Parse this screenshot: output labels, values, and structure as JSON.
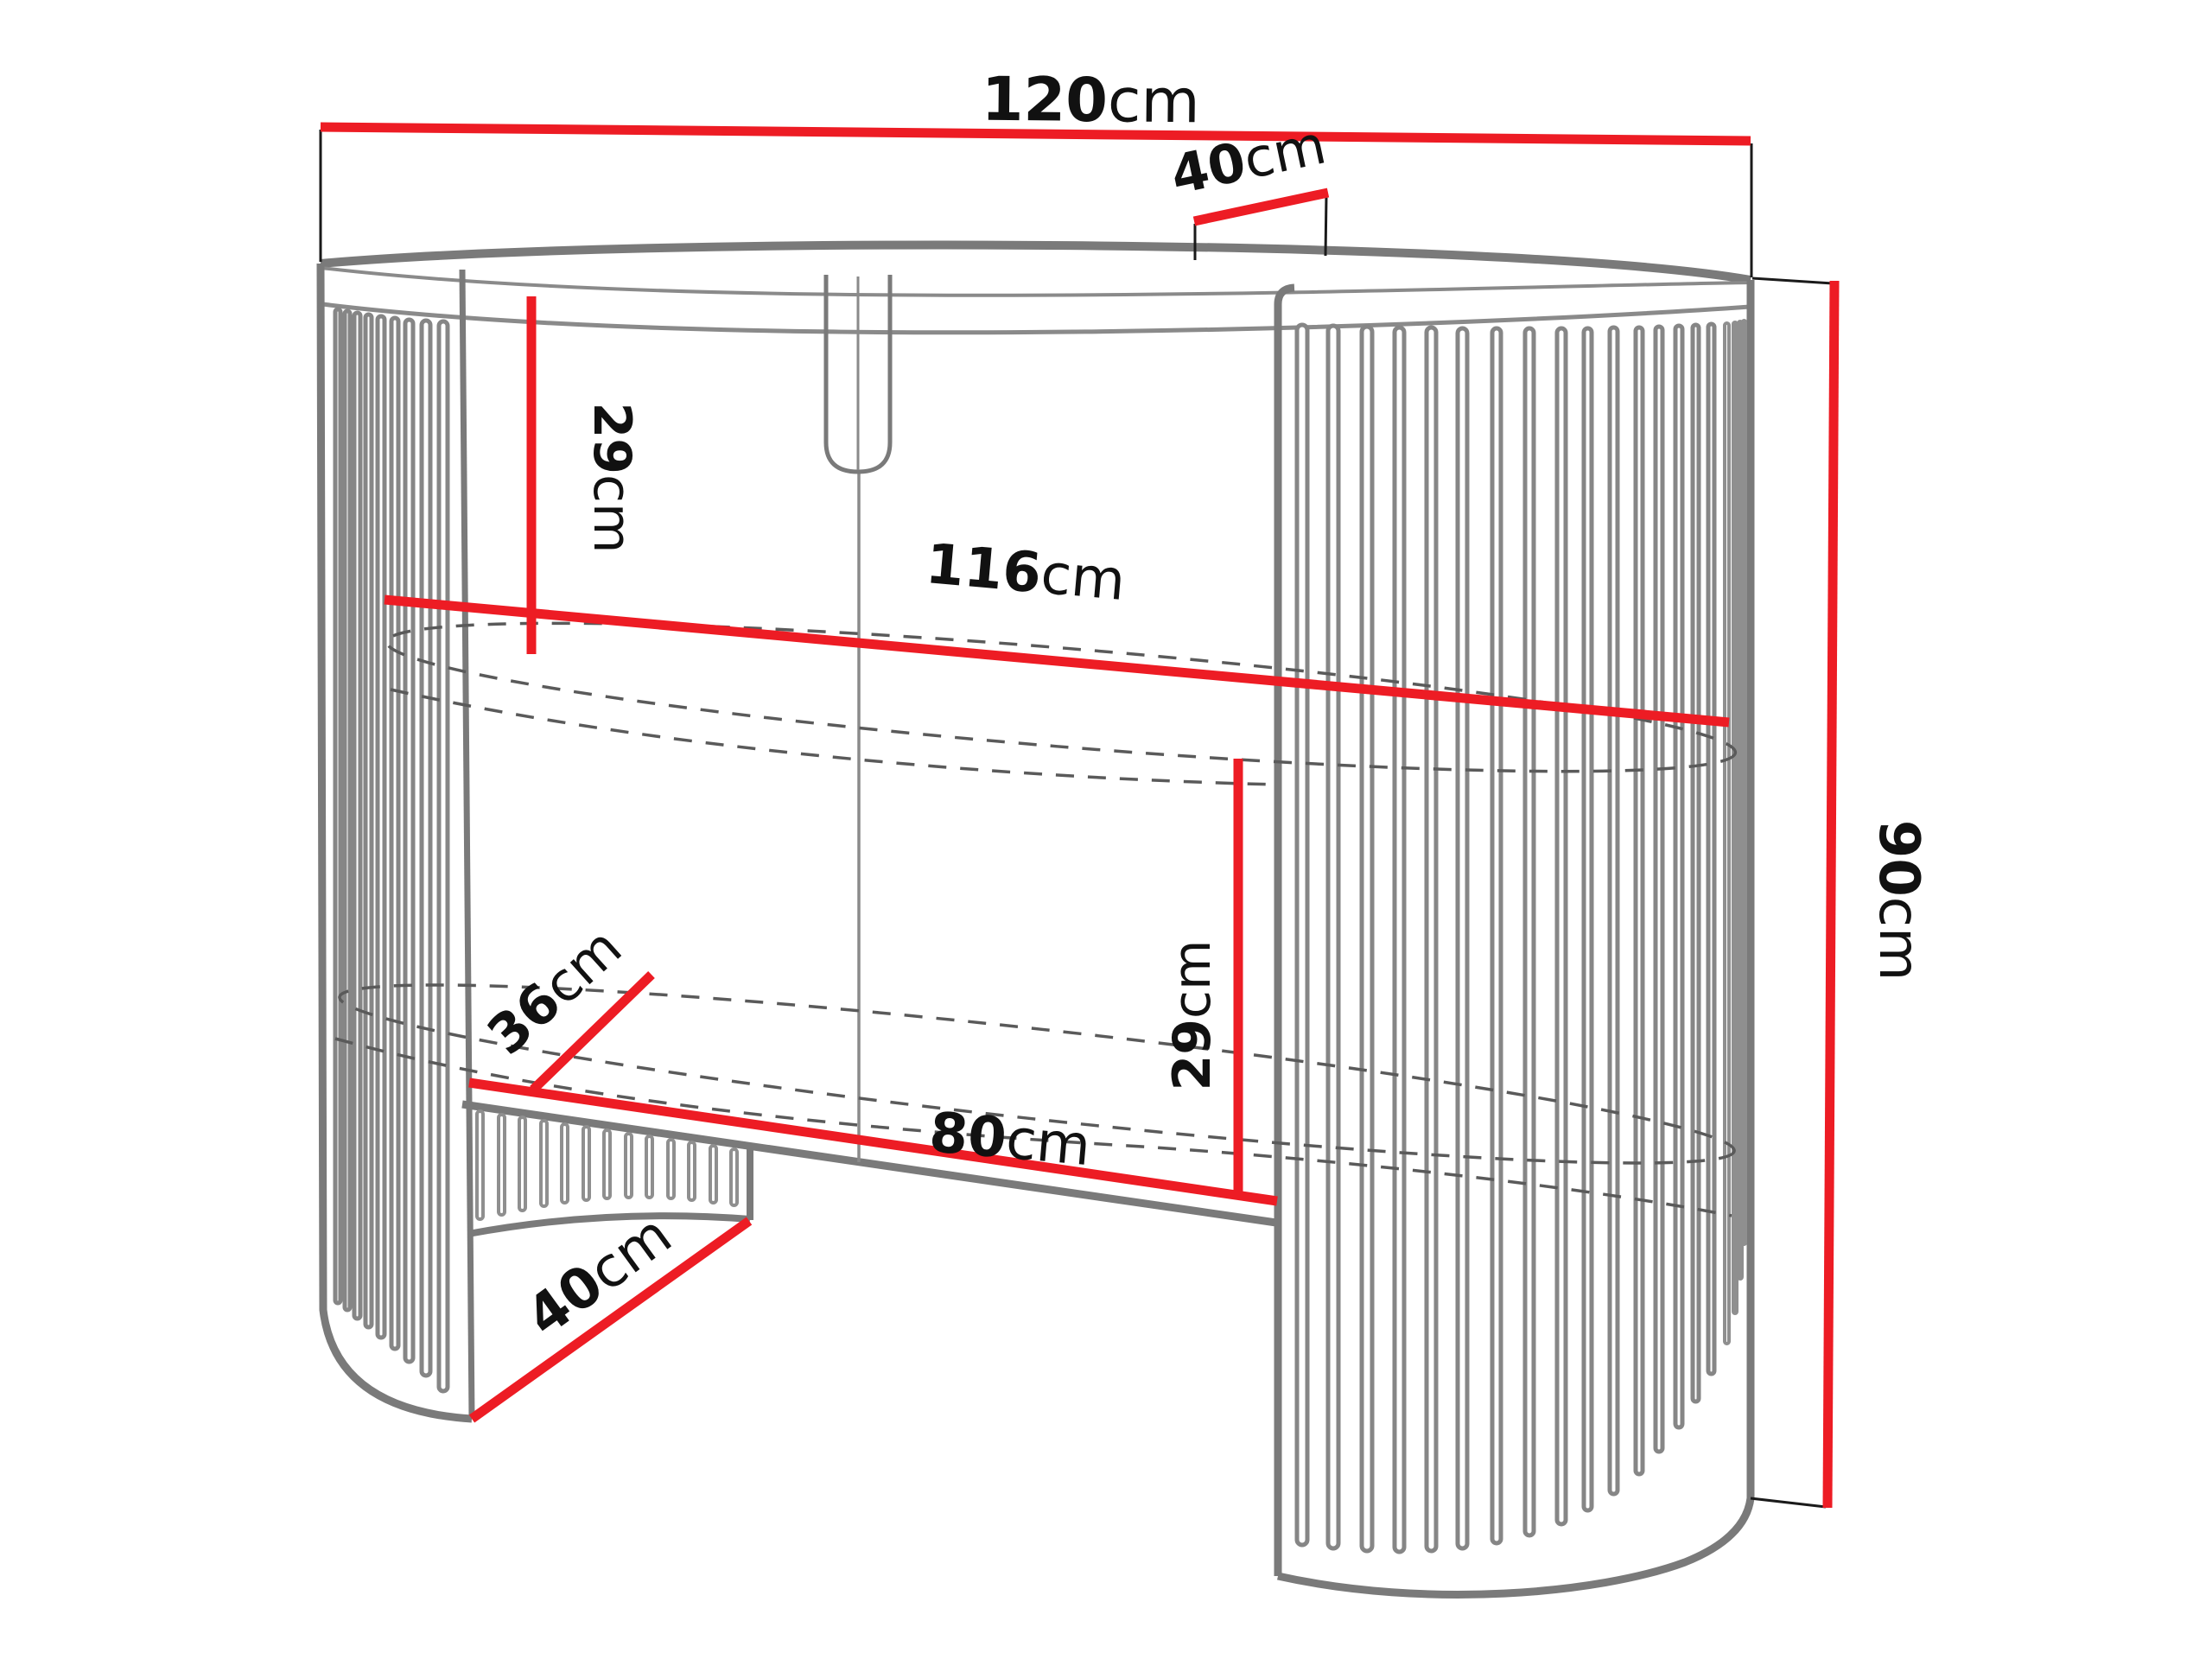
{
  "page": {
    "background": "#ffffff"
  },
  "diagram": {
    "subject": "fluted oval console dressing table - technical dimension drawing",
    "style": {
      "dimension_color": "#ed1c24",
      "outline_color": "#7a7a7a",
      "hidden_line_color": "#5a5a5a",
      "extension_line_color": "#1a1a1a",
      "label_color": "#111111"
    },
    "dimensions": {
      "top_width": {
        "value": "120",
        "unit": "cm"
      },
      "top_depth": {
        "value": "40",
        "unit": "cm"
      },
      "upper_clearance": {
        "value": "29",
        "unit": "cm"
      },
      "inner_width": {
        "value": "116",
        "unit": "cm"
      },
      "shelf_depth": {
        "value": "36",
        "unit": "cm"
      },
      "opening_width": {
        "value": "80",
        "unit": "cm"
      },
      "lower_clearance": {
        "value": "29",
        "unit": "cm"
      },
      "base_depth": {
        "value": "40",
        "unit": "cm"
      },
      "total_height": {
        "value": "90",
        "unit": "cm"
      }
    }
  }
}
